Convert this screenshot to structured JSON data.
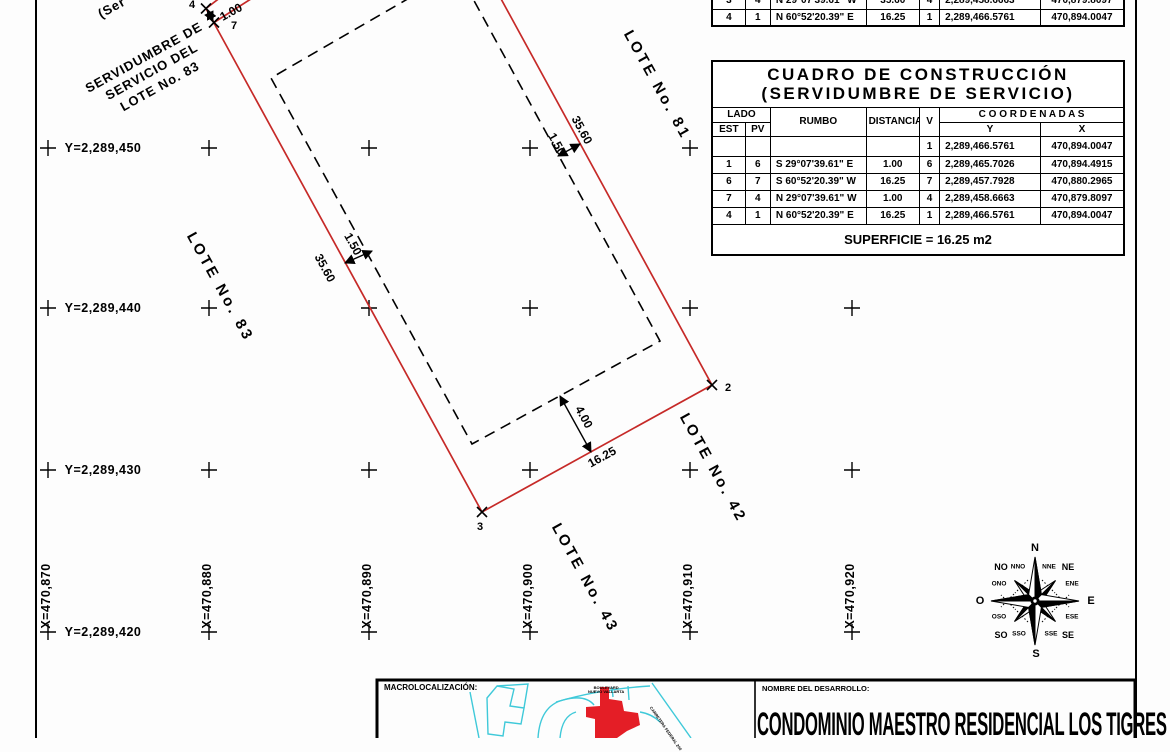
{
  "colors": {
    "accent_red": "#c62a28",
    "map_cyan": "#3fc9d9",
    "map_red": "#e41e26",
    "line_black": "#000000"
  },
  "top_table": {
    "rows": [
      {
        "est": "3",
        "pv": "4",
        "rumbo": "N 29°07'39.61\" W",
        "distancia": "35.60",
        "v": "4",
        "y": "2,289,458.6663",
        "x": "470,879.8097"
      },
      {
        "est": "4",
        "pv": "1",
        "rumbo": "N 60°52'20.39\" E",
        "distancia": "16.25",
        "v": "1",
        "y": "2,289,466.5761",
        "x": "470,894.0047"
      }
    ]
  },
  "main_table": {
    "title_line1": "CUADRO DE CONSTRUCCIÓN",
    "title_line2": "(SERVIDUMBRE DE SERVICIO)",
    "headers": {
      "lado": "LADO",
      "est": "EST",
      "pv": "PV",
      "rumbo": "RUMBO",
      "distancia": "DISTANCIA",
      "v": "V",
      "coordenadas": "C O O R D E N A D A S",
      "y": "Y",
      "x": "X"
    },
    "rows": [
      {
        "est": "",
        "pv": "",
        "rumbo": "",
        "distancia": "",
        "v": "1",
        "y": "2,289,466.5761",
        "x": "470,894.0047"
      },
      {
        "est": "1",
        "pv": "6",
        "rumbo": "S 29°07'39.61\" E",
        "distancia": "1.00",
        "v": "6",
        "y": "2,289,465.7026",
        "x": "470,894.4915"
      },
      {
        "est": "6",
        "pv": "7",
        "rumbo": "S 60°52'20.39\" W",
        "distancia": "16.25",
        "v": "7",
        "y": "2,289,457.7928",
        "x": "470,880.2965"
      },
      {
        "est": "7",
        "pv": "4",
        "rumbo": "N 29°07'39.61\" W",
        "distancia": "1.00",
        "v": "4",
        "y": "2,289,458.6663",
        "x": "470,879.8097"
      },
      {
        "est": "4",
        "pv": "1",
        "rumbo": "N 60°52'20.39\" E",
        "distancia": "16.25",
        "v": "1",
        "y": "2,289,466.5761",
        "x": "470,894.0047"
      }
    ],
    "superficie": "SUPERFICIE = 16.25 m2"
  },
  "grid": {
    "y_labels": [
      "Y=2,289,450",
      "Y=2,289,440",
      "Y=2,289,430",
      "Y=2,289,420"
    ],
    "x_labels": [
      "X=470,870",
      "X=470,880",
      "X=470,890",
      "X=470,900",
      "X=470,910",
      "X=470,920"
    ]
  },
  "plot": {
    "lot_83": "LOTE No. 83",
    "lot_81": "LOTE No. 81",
    "lot_42": "LOTE No. 42",
    "lot_43": "LOTE No. 43",
    "servidumbre_lines": [
      "SERVIDUMBRE DE",
      "SERVICIO DEL",
      "LOTE No. 83"
    ],
    "partial_label": "(Ser",
    "dims": {
      "left_3560": "35.60",
      "left_150": "1.50",
      "right_3560": "35.60",
      "right_150": "1.50",
      "bottom_1625": "16.25",
      "bottom_400": "4.00",
      "top_100": "1.00"
    },
    "vertices": {
      "v2": "2",
      "v3": "3",
      "v4": "4",
      "v7": "7"
    }
  },
  "compass": {
    "n": "N",
    "nne": "NNE",
    "ne": "NE",
    "ene": "ENE",
    "e": "E",
    "ese": "ESE",
    "se": "SE",
    "sse": "SSE",
    "s": "S",
    "sso": "SSO",
    "so": "SO",
    "oso": "OSO",
    "o": "O",
    "ono": "ONO",
    "no": "NO",
    "nno": "NNO"
  },
  "title_block": {
    "macro_label": "MACROLOCALIZACIÓN:",
    "nombre_label": "NOMBRE DEL DESARROLLO:",
    "development_name": "CONDOMINIO MAESTRO RESIDENCIAL LOS TIGRES",
    "map_labels": {
      "boulevard_l1": "BOULEVARD",
      "boulevard_l2": "NUEVO VALLARTA",
      "carretera": "CARRETERA FEDERAL 200"
    }
  }
}
